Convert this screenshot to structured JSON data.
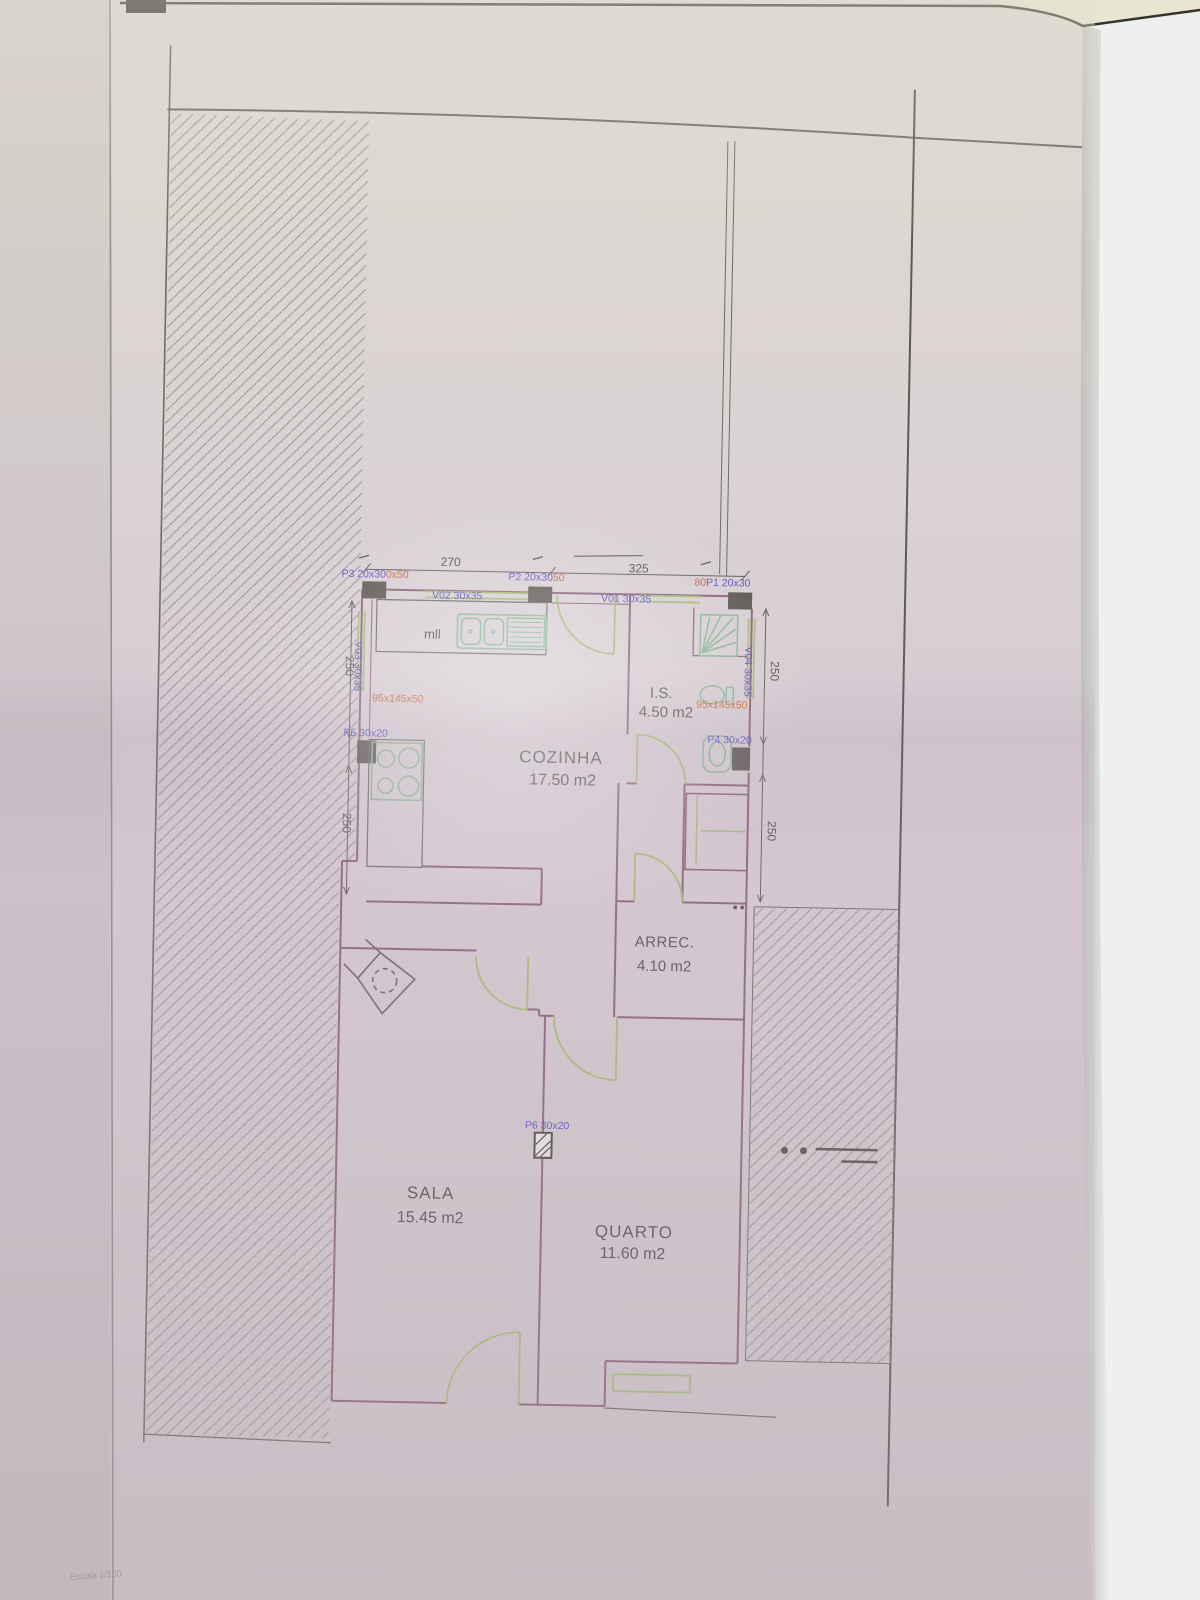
{
  "plan": {
    "rooms": {
      "cozinha": {
        "name": "COZINHA",
        "area": "17.50 m2"
      },
      "is": {
        "name": "I.S.",
        "area": "4.50 m2"
      },
      "arrec": {
        "name": "ARREC.",
        "area": "4.10 m2"
      },
      "sala": {
        "name": "SALA",
        "area": "15.45 m2"
      },
      "quarto": {
        "name": "QUARTO",
        "area": "11.60 m2"
      }
    },
    "openings": {
      "p1": {
        "label": "P1 20x30",
        "beam": "80"
      },
      "p2": {
        "label": "P2 20x30",
        "beam": "50"
      },
      "p3": {
        "label": "P3 20x30",
        "beam": "0x50"
      },
      "p4": {
        "label": "P4 30x20"
      },
      "p5": {
        "label": "P5 30x20"
      },
      "p6": {
        "label": "P6 30x20"
      },
      "v01": {
        "label": "V01 30x35"
      },
      "v02": {
        "label": "V02 30x35"
      },
      "v03": {
        "label": "V03 30x35"
      },
      "v04": {
        "label": "V04 30x35"
      }
    },
    "sills": {
      "left": "95x145x50",
      "right": "95x145x50"
    },
    "dimensions": {
      "top_left": "270",
      "top_right": "325",
      "left_upper": "250",
      "left_lower": "250",
      "right_upper": "250",
      "right_lower": "250"
    },
    "annotations": {
      "appliance": "mll",
      "scale": "Escala 1/100"
    },
    "colors": {
      "wall": "#7c4e66",
      "door": "#9cba5e",
      "fixture": "#79b489",
      "label_blue": "#3d3dbe",
      "label_orange": "#c5521e",
      "text": "#3a3938"
    }
  }
}
